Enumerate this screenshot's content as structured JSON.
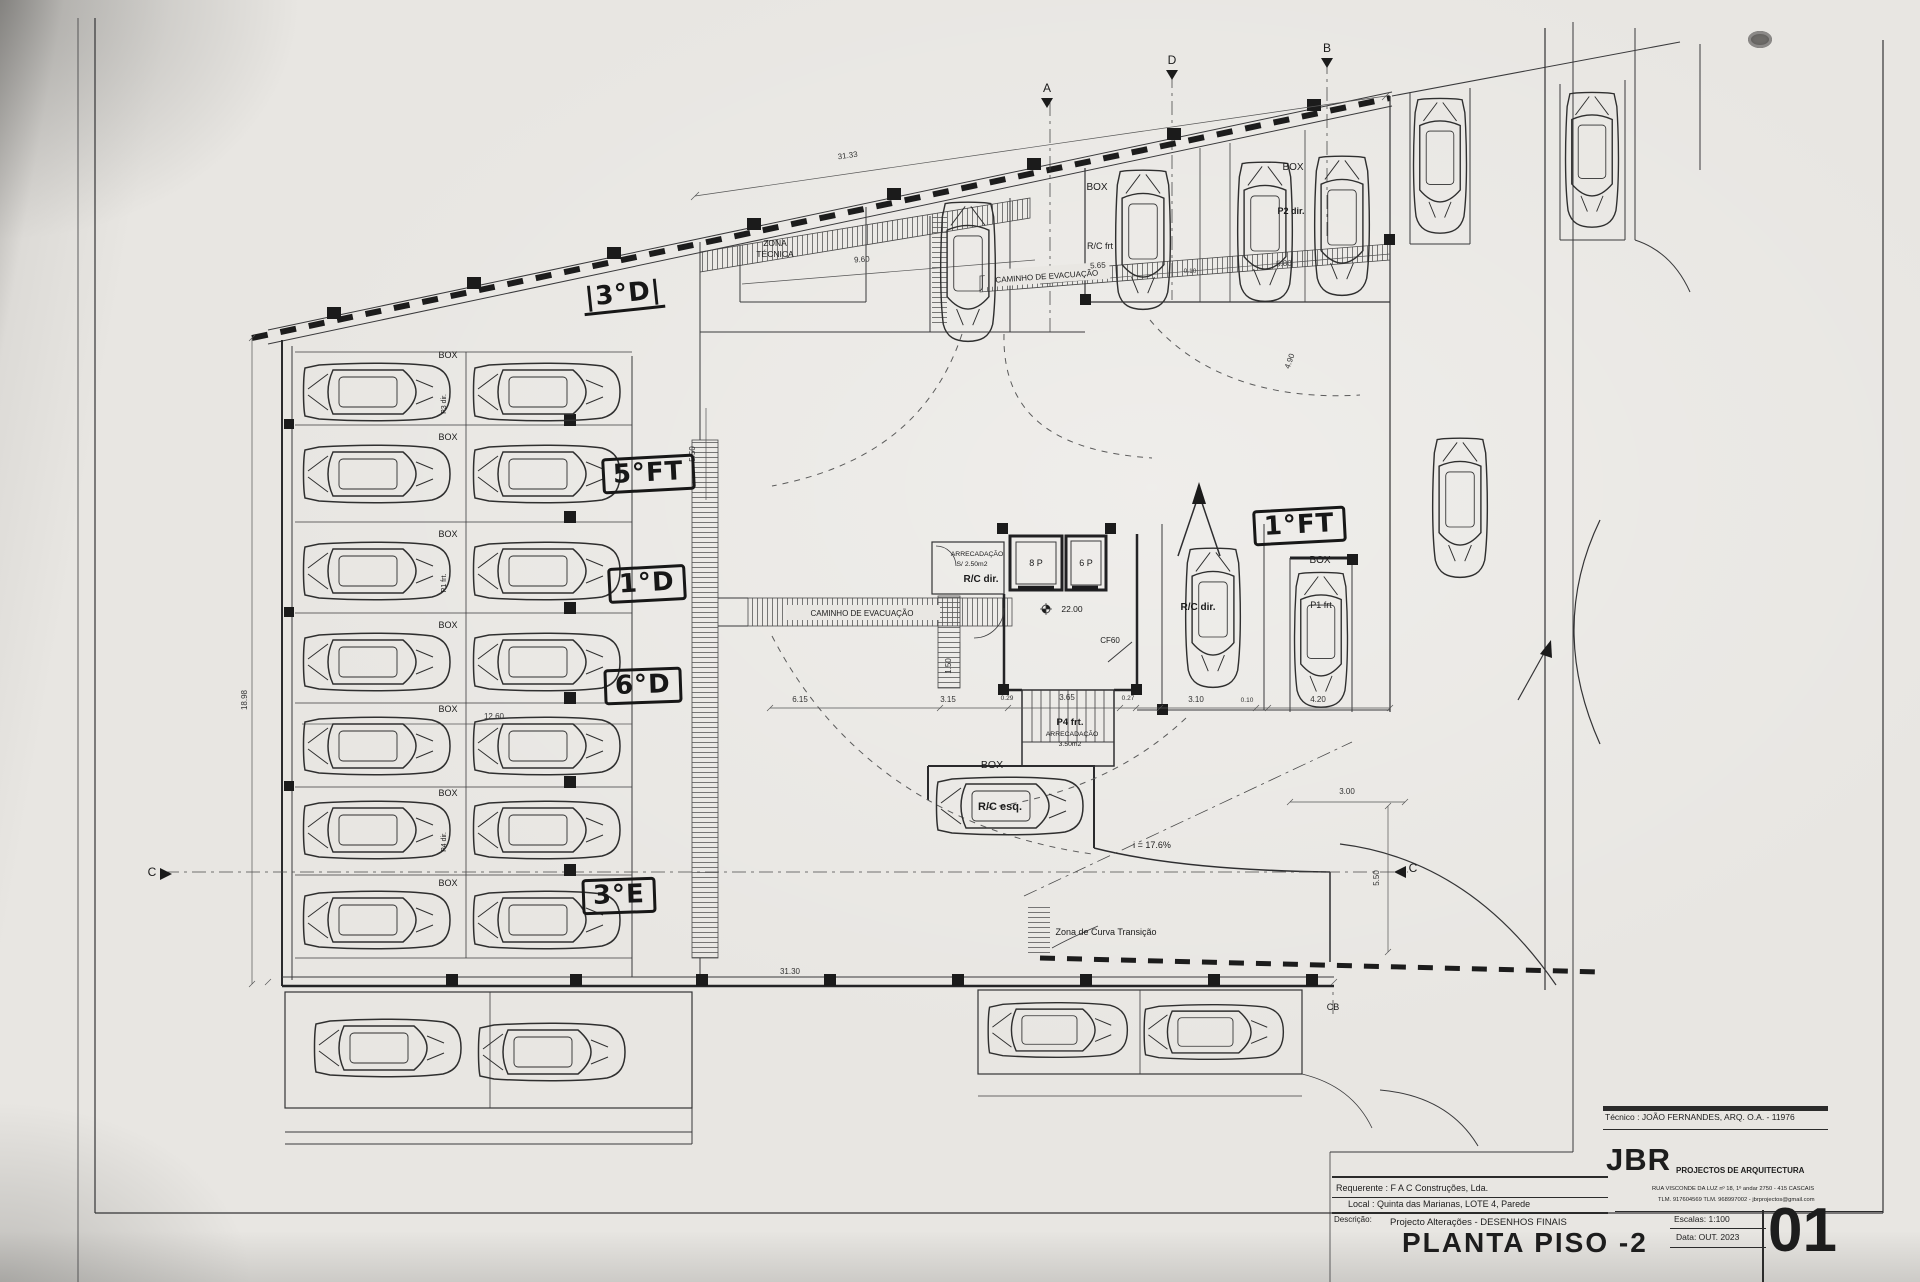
{
  "colors": {
    "paper": "#e8e6e2",
    "ink": "#2a2a2a"
  },
  "titleblock": {
    "tecnico": "Técnico : JOÃO FERNANDES, ARQ.   O.A. - 11976",
    "firm": "JBR",
    "firm_tagline": "PROJECTOS DE ARQUITECTURA",
    "firm_address": "RUA VISCONDE DA LUZ nº 18, 1º andar  2750 - 415  CASCAIS",
    "firm_contacts": "TLM. 917604569  TLM. 968997002  -  jbrprojectos@gmail.com",
    "requerente": "Requerente : F A C  Construções, Lda.",
    "local": "Local : Quinta das Marianas, LOTE 4, Parede",
    "descricao_label": "Descrição:",
    "descricao": "Projecto Alterações - DESENHOS FINAIS",
    "title": "PLANTA PISO -2",
    "escala": "Escalas:  1:100",
    "data": "Data: OUT.  2023",
    "sheet": "01"
  },
  "plan": {
    "handwritten": [
      {
        "text": "|3°D|",
        "x": 583,
        "y": 281,
        "rot": -6,
        "boxed": false,
        "underline": true
      },
      {
        "text": "5°FT",
        "x": 602,
        "y": 456,
        "rot": -3,
        "boxed": true,
        "underline": false
      },
      {
        "text": "1°D",
        "x": 608,
        "y": 566,
        "rot": -3,
        "boxed": true,
        "underline": false
      },
      {
        "text": "6°D",
        "x": 604,
        "y": 668,
        "rot": -2,
        "boxed": true,
        "underline": false
      },
      {
        "text": "3°E",
        "x": 582,
        "y": 878,
        "rot": -2,
        "boxed": true,
        "underline": false
      },
      {
        "text": "1°FT",
        "x": 1253,
        "y": 508,
        "rot": -3,
        "boxed": true,
        "underline": false
      }
    ],
    "labels": [
      {
        "t": "ZONA",
        "x": 775,
        "y": 246,
        "s": 8.5
      },
      {
        "t": "TÉCNICA",
        "x": 775,
        "y": 257,
        "s": 8.5
      },
      {
        "t": "CAMINHO  DE  EVACUAÇÃO",
        "x": 1047,
        "y": 279,
        "s": 8,
        "r": -4
      },
      {
        "t": "CAMINHO  DE  EVACUAÇÃO",
        "x": 862,
        "y": 616,
        "s": 8
      },
      {
        "t": "BOX",
        "x": 1097,
        "y": 190,
        "s": 10
      },
      {
        "t": "R/C frt",
        "x": 1100,
        "y": 249,
        "s": 9
      },
      {
        "t": "BOX",
        "x": 1293,
        "y": 170,
        "s": 10
      },
      {
        "t": "P2 dir.",
        "x": 1291,
        "y": 214,
        "s": 9,
        "b": 1
      },
      {
        "t": "BOX",
        "x": 448,
        "y": 358,
        "s": 9
      },
      {
        "t": "BOX",
        "x": 448,
        "y": 440,
        "s": 9
      },
      {
        "t": "BOX",
        "x": 448,
        "y": 537,
        "s": 9
      },
      {
        "t": "BOX",
        "x": 448,
        "y": 628,
        "s": 9
      },
      {
        "t": "BOX",
        "x": 448,
        "y": 712,
        "s": 9
      },
      {
        "t": "BOX",
        "x": 448,
        "y": 796,
        "s": 9
      },
      {
        "t": "BOX",
        "x": 448,
        "y": 886,
        "s": 9
      },
      {
        "t": "P3 dir.",
        "x": 446,
        "y": 404,
        "s": 7,
        "r": -90
      },
      {
        "t": "P1 frt.",
        "x": 446,
        "y": 583,
        "s": 7,
        "r": -90
      },
      {
        "t": "P4 dir.",
        "x": 446,
        "y": 842,
        "s": 7,
        "r": -90
      },
      {
        "t": "ARRECADAÇÃO",
        "x": 977,
        "y": 556,
        "s": 6.8
      },
      {
        "t": "S/ 2.50m2",
        "x": 972,
        "y": 566,
        "s": 6.8
      },
      {
        "t": "R/C dir.",
        "x": 981,
        "y": 582,
        "s": 10,
        "b": 1
      },
      {
        "t": "8 P",
        "x": 1036,
        "y": 566,
        "s": 9
      },
      {
        "t": "6 P",
        "x": 1086,
        "y": 566,
        "s": 9
      },
      {
        "t": "22.00",
        "x": 1072,
        "y": 612,
        "s": 8.5
      },
      {
        "t": "CF60",
        "x": 1110,
        "y": 643,
        "s": 8
      },
      {
        "t": "P4 frt.",
        "x": 1070,
        "y": 725,
        "s": 9.5,
        "b": 1
      },
      {
        "t": "ARRECADAÇÃO",
        "x": 1072,
        "y": 736,
        "s": 6.8
      },
      {
        "t": "3.50m2",
        "x": 1070,
        "y": 746,
        "s": 6.8
      },
      {
        "t": "BOX",
        "x": 992,
        "y": 768,
        "s": 10.5
      },
      {
        "t": "R/C esq.",
        "x": 1000,
        "y": 810,
        "s": 11,
        "b": 1
      },
      {
        "t": "i = 17.6%",
        "x": 1152,
        "y": 848,
        "s": 9
      },
      {
        "t": "Zona de Curva Transição",
        "x": 1106,
        "y": 935,
        "s": 9
      },
      {
        "t": "R/C dir.",
        "x": 1198,
        "y": 610,
        "s": 10,
        "b": 1
      },
      {
        "t": "BOX",
        "x": 1320,
        "y": 563,
        "s": 10
      },
      {
        "t": "P1 frt",
        "x": 1321,
        "y": 608,
        "s": 9
      },
      {
        "t": "A",
        "x": 1047,
        "y": 92,
        "s": 12,
        "n": "section-marker-a"
      },
      {
        "t": "D",
        "x": 1172,
        "y": 64,
        "s": 12,
        "n": "section-marker-d"
      },
      {
        "t": "B",
        "x": 1327,
        "y": 52,
        "s": 12,
        "n": "section-marker-b"
      },
      {
        "t": "C",
        "x": 152,
        "y": 876,
        "s": 12,
        "n": "section-marker-c-left"
      },
      {
        "t": "C",
        "x": 1413,
        "y": 872,
        "s": 12,
        "n": "section-marker-c-right"
      },
      {
        "t": "CB",
        "x": 1333,
        "y": 1010,
        "s": 9,
        "n": "section-marker-cb"
      }
    ],
    "dimensions": [
      {
        "t": "31.33",
        "x": 848,
        "y": 158,
        "r": -8
      },
      {
        "t": "9.60",
        "x": 862,
        "y": 262,
        "r": -4
      },
      {
        "t": "5.65",
        "x": 1098,
        "y": 268,
        "r": -3
      },
      {
        "t": "0.10",
        "x": 1190,
        "y": 273,
        "s": 6.5
      },
      {
        "t": "5.80",
        "x": 1284,
        "y": 266,
        "r": -3
      },
      {
        "t": "18.98",
        "x": 247,
        "y": 700,
        "r": -90
      },
      {
        "t": "12.60",
        "x": 494,
        "y": 719
      },
      {
        "t": "5.50",
        "x": 695,
        "y": 454,
        "r": -90
      },
      {
        "t": "1.50",
        "x": 951,
        "y": 666,
        "r": -90
      },
      {
        "t": "4.90",
        "x": 1292,
        "y": 362,
        "r": -70
      },
      {
        "t": "6.15",
        "x": 800,
        "y": 702
      },
      {
        "t": "3.15",
        "x": 948,
        "y": 702
      },
      {
        "t": "0.29",
        "x": 1007,
        "y": 700,
        "s": 6.5
      },
      {
        "t": "3.65",
        "x": 1067,
        "y": 700
      },
      {
        "t": "0.27",
        "x": 1128,
        "y": 700,
        "s": 6.5
      },
      {
        "t": "3.10",
        "x": 1196,
        "y": 702
      },
      {
        "t": "0.10",
        "x": 1247,
        "y": 702,
        "s": 6.5
      },
      {
        "t": "4.20",
        "x": 1318,
        "y": 702
      },
      {
        "t": "3.00",
        "x": 1347,
        "y": 794
      },
      {
        "t": "5.50",
        "x": 1379,
        "y": 878,
        "r": -90
      },
      {
        "t": "31.30",
        "x": 790,
        "y": 974
      }
    ],
    "cars": [
      {
        "x": 377,
        "y": 392,
        "r": 0,
        "s": 1
      },
      {
        "x": 547,
        "y": 392,
        "r": 0,
        "s": 1
      },
      {
        "x": 377,
        "y": 474,
        "r": 0,
        "s": 1
      },
      {
        "x": 547,
        "y": 474,
        "r": 0,
        "s": 1
      },
      {
        "x": 377,
        "y": 571,
        "r": 0,
        "s": 1
      },
      {
        "x": 547,
        "y": 571,
        "r": 0,
        "s": 1
      },
      {
        "x": 377,
        "y": 662,
        "r": 0,
        "s": 1
      },
      {
        "x": 547,
        "y": 662,
        "r": 0,
        "s": 1
      },
      {
        "x": 377,
        "y": 746,
        "r": 0,
        "s": 1
      },
      {
        "x": 547,
        "y": 746,
        "r": 0,
        "s": 1
      },
      {
        "x": 377,
        "y": 830,
        "r": 0,
        "s": 1
      },
      {
        "x": 547,
        "y": 830,
        "r": 0,
        "s": 1
      },
      {
        "x": 377,
        "y": 920,
        "r": 0,
        "s": 1
      },
      {
        "x": 547,
        "y": 920,
        "r": 0,
        "s": 1
      },
      {
        "x": 968,
        "y": 272,
        "r": 90,
        "s": 0.95
      },
      {
        "x": 1143,
        "y": 240,
        "r": 90,
        "s": 0.95
      },
      {
        "x": 1265,
        "y": 232,
        "r": 90,
        "s": 0.95
      },
      {
        "x": 1342,
        "y": 226,
        "r": 90,
        "s": 0.95
      },
      {
        "x": 1440,
        "y": 166,
        "r": 90,
        "s": 0.92
      },
      {
        "x": 1592,
        "y": 160,
        "r": 90,
        "s": 0.92
      },
      {
        "x": 1460,
        "y": 508,
        "r": 90,
        "s": 0.95
      },
      {
        "x": 1213,
        "y": 618,
        "r": 90,
        "s": 0.95
      },
      {
        "x": 1321,
        "y": 640,
        "r": 90,
        "s": 0.92
      },
      {
        "x": 1010,
        "y": 806,
        "r": 0,
        "s": 1
      },
      {
        "x": 388,
        "y": 1048,
        "r": 0,
        "s": 1
      },
      {
        "x": 552,
        "y": 1052,
        "r": 0,
        "s": 1
      },
      {
        "x": 1058,
        "y": 1030,
        "r": 0,
        "s": 0.95
      },
      {
        "x": 1214,
        "y": 1032,
        "r": 0,
        "s": 0.95
      }
    ]
  }
}
